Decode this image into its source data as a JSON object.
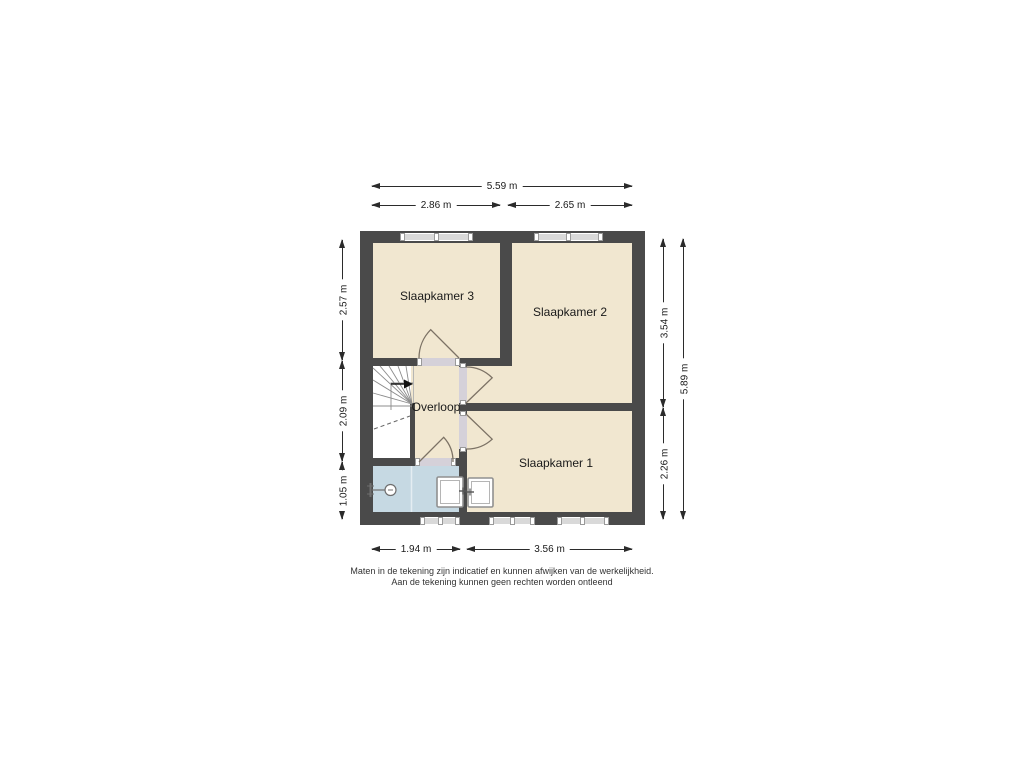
{
  "rooms": {
    "slaapkamer3": "Slaapkamer 3",
    "slaapkamer2": "Slaapkamer 2",
    "slaapkamer1": "Slaapkamer 1",
    "overloop": "Overloop"
  },
  "dimensions": {
    "top_total": "5.59 m",
    "top_left": "2.86 m",
    "top_right": "2.65 m",
    "left_top": "2.57 m",
    "left_middle": "2.09 m",
    "left_bottom": "1.05 m",
    "right_top": "3.54 m",
    "right_bottom": "2.26 m",
    "right_total": "5.89 m",
    "bottom_left": "1.94 m",
    "bottom_right": "3.56 m"
  },
  "footer": {
    "line1": "Maten in de tekening zijn indicatief en kunnen afwijken van de werkelijkheid.",
    "line2": "Aan de tekening kunnen geen rechten worden ontleend"
  },
  "fixtures": {
    "shower": "shower-head-icon",
    "washbasin_count": 2,
    "stairs_arrow": "up-direction-right"
  },
  "colors": {
    "room_fill": "#f1e7d0",
    "wet_room_fill": "#c6d9e3",
    "wall": "#4a4a4a",
    "window": "#d9d9d9",
    "threshold": "#d5d1d9",
    "dim_line": "#2b2b2b",
    "text": "#1a1a1a"
  }
}
